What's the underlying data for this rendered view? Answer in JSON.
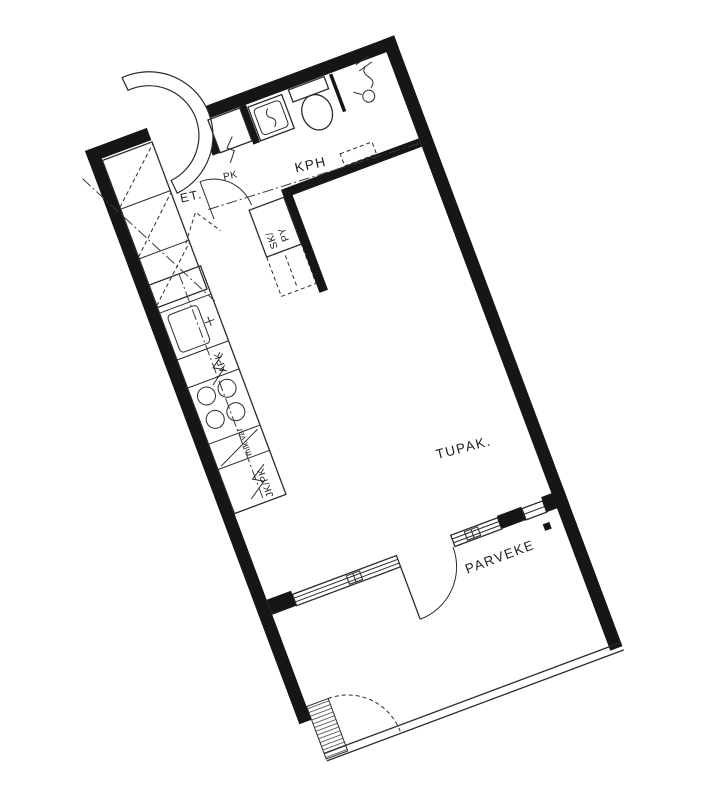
{
  "floor_plan": {
    "rooms": {
      "entry": {
        "label": "ET."
      },
      "bathroom": {
        "label": "KPH"
      },
      "living_kitchen": {
        "label": "TUPAK."
      },
      "balcony": {
        "label": "PARVEKE"
      }
    },
    "fixtures": {
      "washing_machine": {
        "label": "PK"
      },
      "cleaning_closet": {
        "line1": "SK/",
        "line2": "PY"
      },
      "dishwasher": {
        "label": "APK"
      },
      "microwave_reservation": {
        "label": "mik.var"
      },
      "fridge_freezer": {
        "label": "JK/PK"
      }
    },
    "colors": {
      "background": "#ffffff",
      "wall": "#161616",
      "line": "#2b2b2b"
    }
  }
}
